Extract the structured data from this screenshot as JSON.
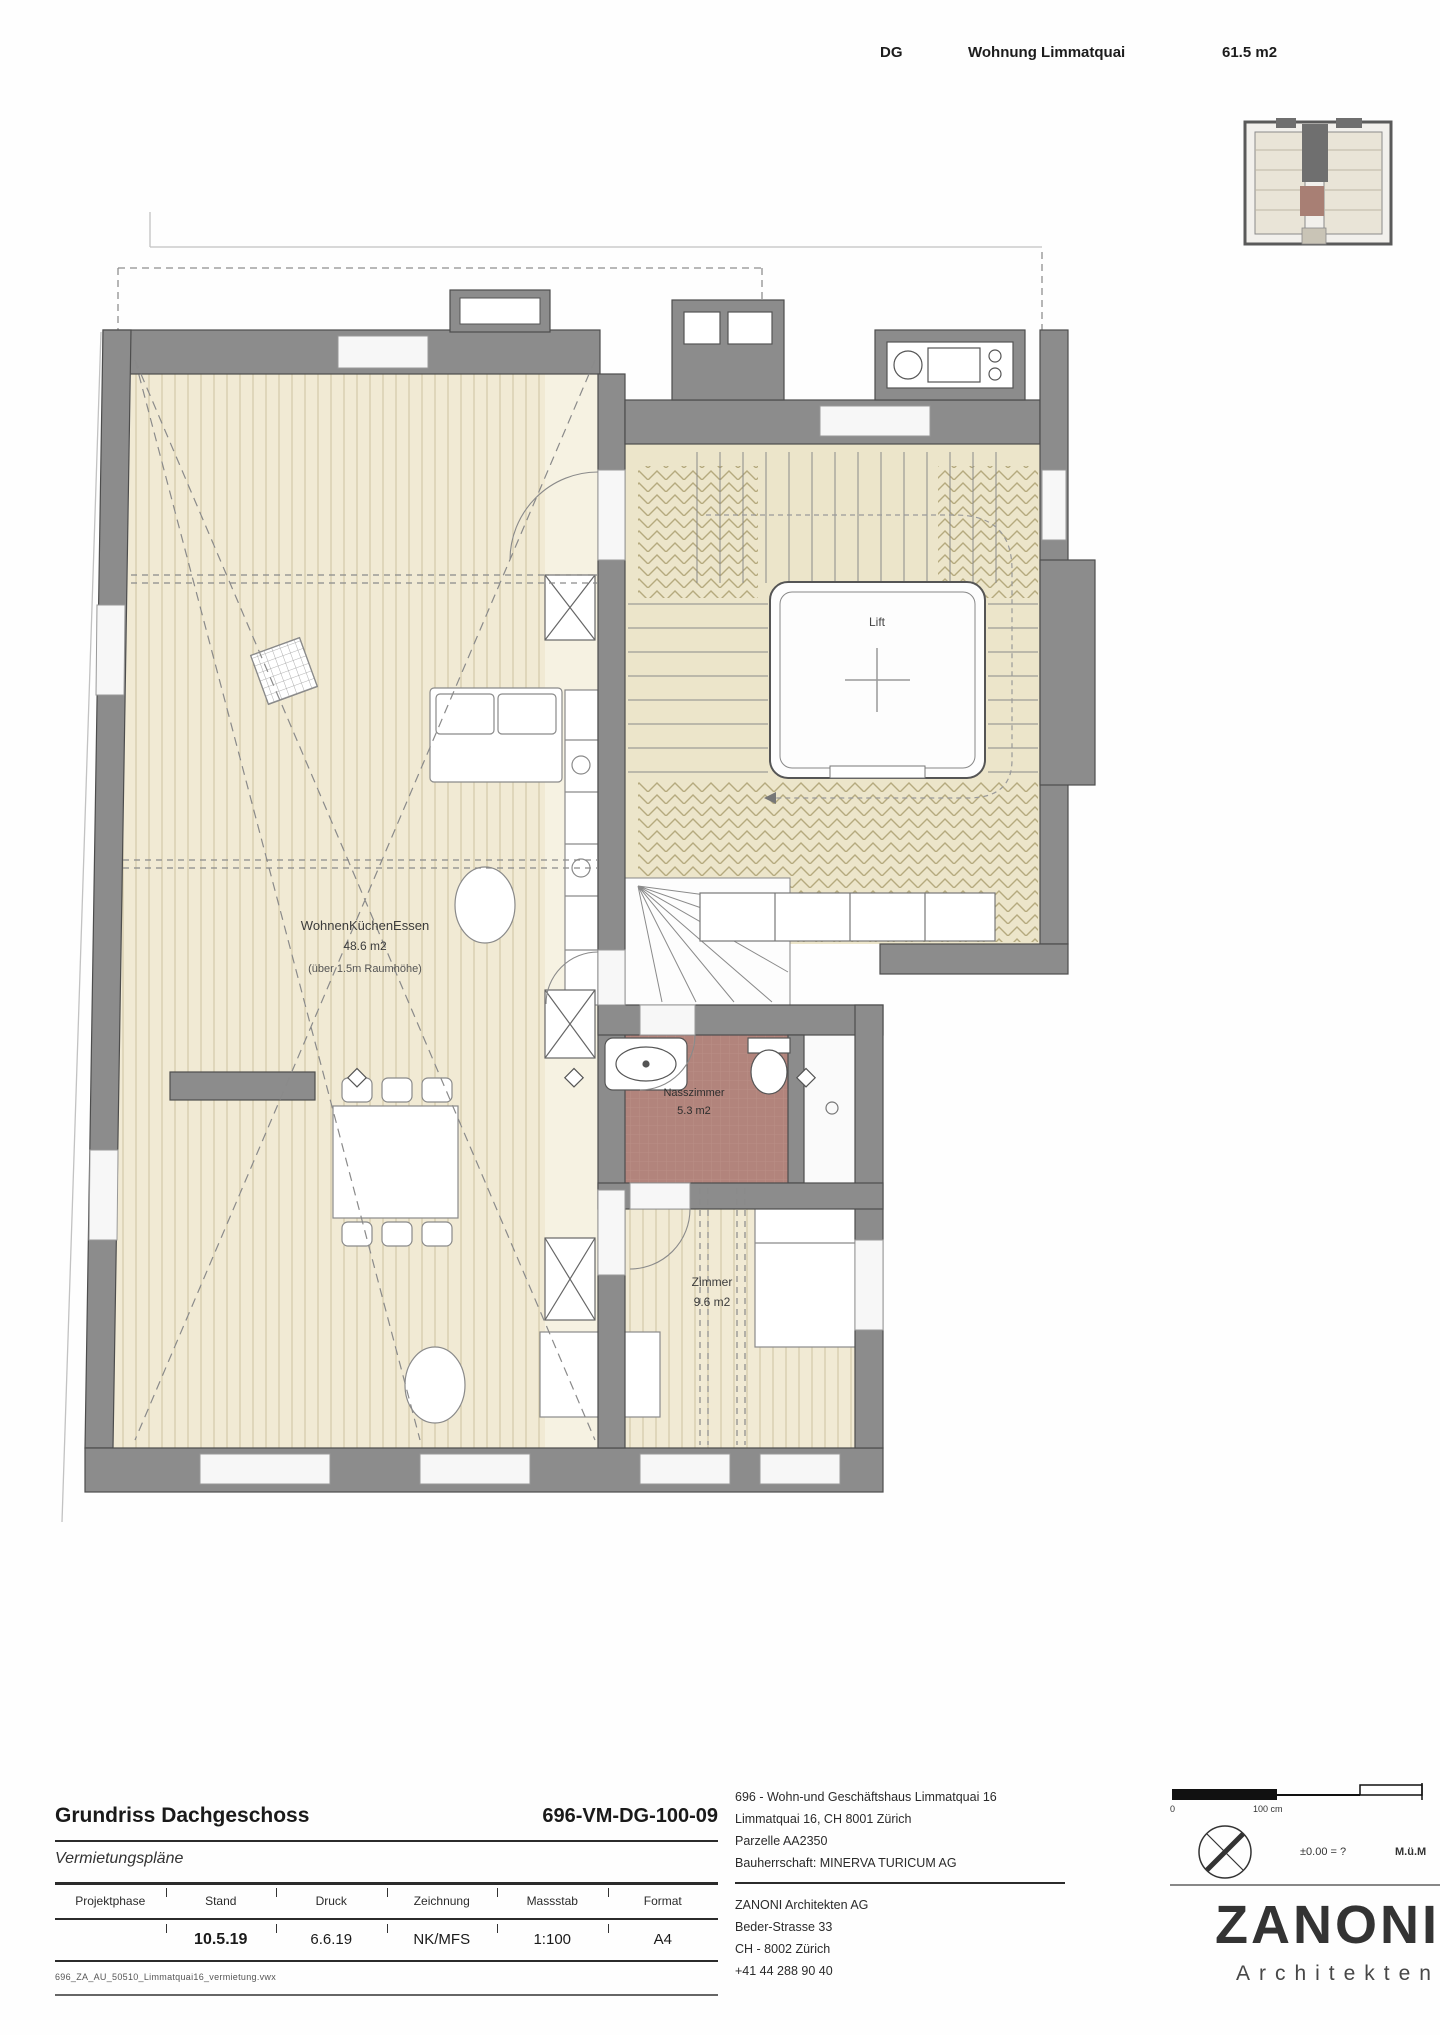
{
  "header": {
    "floor": "DG",
    "name": "Wohnung Limmatquai",
    "area": "61.5 m2"
  },
  "plan": {
    "living": {
      "name": "WohnenKüchenEssen",
      "area": "48.6 m2",
      "note": "(über 1.5m Raumhöhe)"
    },
    "lift": {
      "label": "Lift"
    },
    "bath": {
      "name": "Nasszimmer",
      "area": "5.3 m2"
    },
    "room": {
      "name": "Zimmer",
      "area": "9.6 m2"
    }
  },
  "title_block": {
    "drawing_title": "Grundriss Dachgeschoss",
    "drawing_number": "696-VM-DG-100-09",
    "plan_set": "Vermietungspläne",
    "columns": [
      "Projektphase",
      "Stand",
      "Druck",
      "Zeichnung",
      "Massstab",
      "Format"
    ],
    "values": {
      "projektphase": "",
      "stand": "10.5.19",
      "druck": "6.6.19",
      "zeichnung": "NK/MFS",
      "massstab": "1:100",
      "format": "A4"
    },
    "file_name": "696_ZA_AU_50510_Limmatquai16_vermietung.vwx"
  },
  "project": {
    "name": "696 - Wohn-und Geschäftshaus Limmatquai 16",
    "address": "Limmatquai 16, CH 8001 Zürich",
    "parcel": "Parzelle AA2350",
    "client": "Bauherrschaft: MINERVA TURICUM AG"
  },
  "architect": {
    "name": "ZANONI Architekten AG",
    "street": "Beder-Strasse 33",
    "city": "CH - 8002 Zürich",
    "phone": "+41 44 288 90 40"
  },
  "logo": {
    "name": "ZANONI",
    "subtitle": "Architekten"
  },
  "scale": {
    "zero": "0",
    "label": "100 cm",
    "elevation": "±0.00  =  ?",
    "unit": "M.ü.M"
  },
  "colors": {
    "wall": "#8c8c8c",
    "wall_line": "#4d4d4d",
    "wood_floor": "#f1ead4",
    "wood_stripe": "#cdc3a0",
    "parquet": "#ece5ca",
    "parquet_hatch": "#b5aa7e",
    "bath": "#b2847c"
  }
}
